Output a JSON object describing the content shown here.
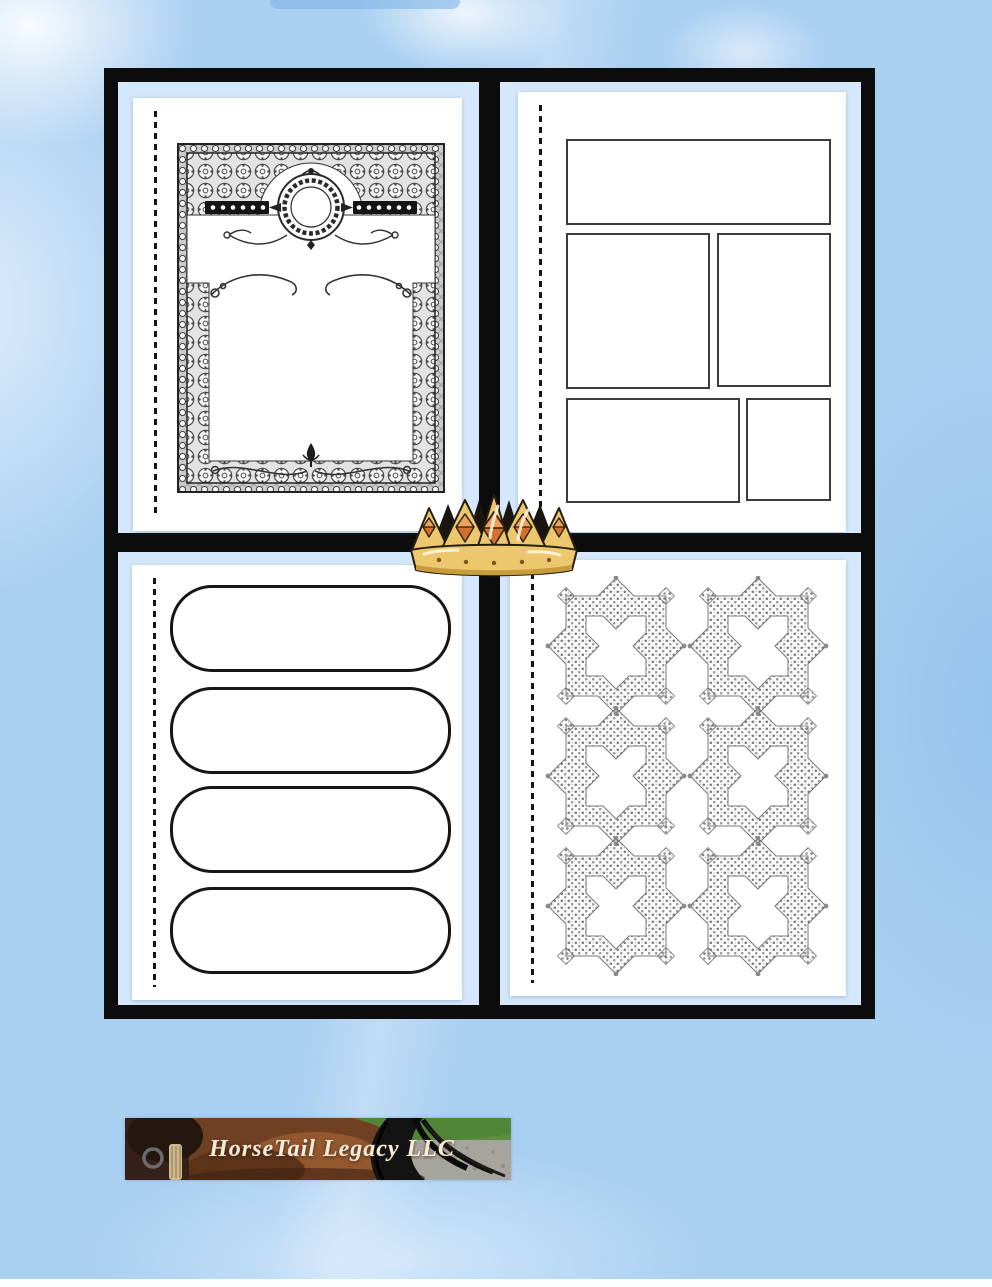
{
  "banner": {
    "title": "HorseTail Legacy LLC"
  },
  "icons": {
    "crown": "crown-icon",
    "top_left_template": "ornate-certificate-frame",
    "top_right_template": "photo-layout-boxes",
    "bottom_left_template": "rounded-label-strips",
    "bottom_right_template": "ornamental-square-frames",
    "banner_photo": "horse-tail-photo"
  },
  "colors": {
    "background_blue": "#a9cff1",
    "cell_blue": "#d5e8fb",
    "frame_black": "#0c0c0c",
    "page_white": "#ffffff",
    "crown_gold": "#ecc76d",
    "crown_jewel_light": "#f2a058",
    "crown_jewel_dark": "#d2702e",
    "banner_text_cream": "#f6ecd9"
  }
}
